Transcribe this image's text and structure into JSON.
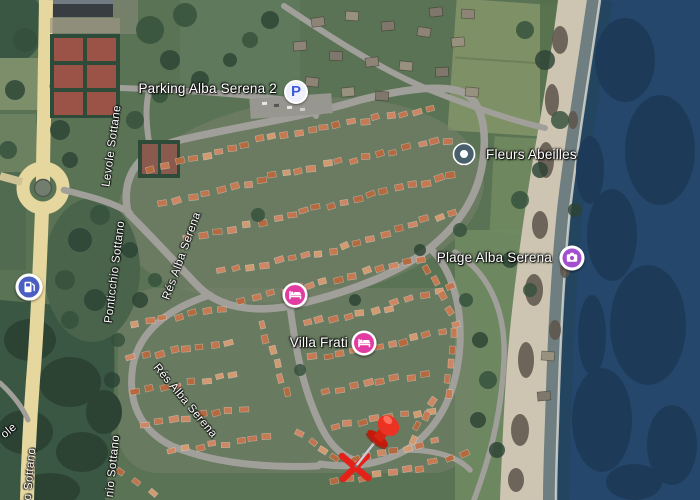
{
  "map": {
    "view": "satellite",
    "poi": {
      "parking": {
        "label": "Parking Alba Serena 2",
        "icon": "parking-p",
        "letter": "P"
      },
      "fleurs": {
        "label": "Fleurs Abeilles",
        "icon": "place-pin"
      },
      "plage": {
        "label": "Plage Alba Serena",
        "icon": "photo-camera"
      },
      "villa": {
        "label": "Villa Frati",
        "icon": "lodging-bed"
      },
      "lodging_unlabeled": {
        "label": "",
        "icon": "lodging-bed"
      },
      "gas_station": {
        "label": "",
        "icon": "fuel-pump"
      }
    },
    "streets": {
      "levole": "Levole Sottane",
      "ponticchio": "Ponticchio Sottano",
      "res_alba_1": "Rés Alba Serena",
      "res_alba_2": "Rés Alba Serena",
      "o_sottano": "o Sottano",
      "nio_sottano": "nio Sottano",
      "ole_partial": "ole"
    },
    "annotation": {
      "type": "red pushpin pointing to red X mark"
    },
    "colors": {
      "sea": "#26476c",
      "sea_dark": "#1d3a58",
      "beach": "#cdc5b2",
      "grass": "#5b7355",
      "forest": "#3a5743",
      "road_main": "#e6d79f",
      "road": "#a19f9a",
      "roof": "#c0754f",
      "parking_blue": "#3f5bd9",
      "pin_slate": "#49606c",
      "attraction_purple": "#a44fd0",
      "lodging_pink": "#e23ba2",
      "gas_blue": "#4a5fc1",
      "annotation_red": "#e32119",
      "court": "#9b5348",
      "court_frame": "#2e4a39"
    }
  }
}
